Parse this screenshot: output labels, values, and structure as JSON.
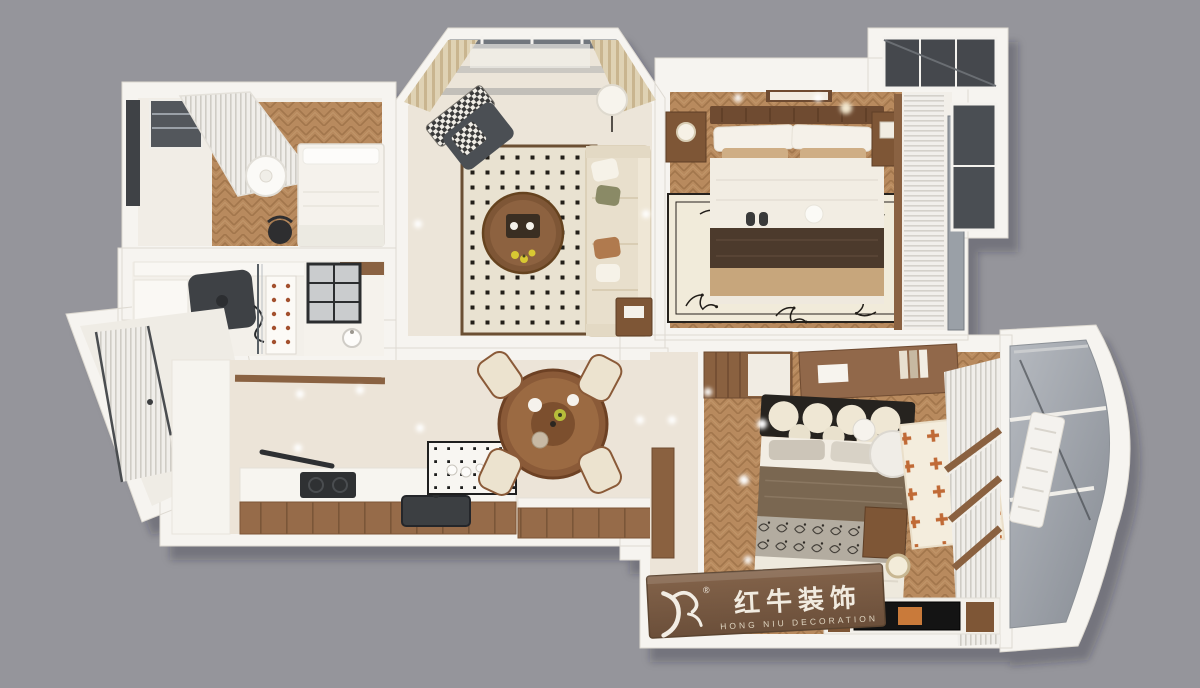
{
  "scene": {
    "type": "3D apartment floor-plan render, top-down view",
    "background_color": "#95959B"
  },
  "watermark": {
    "brand_cn": "红牛装饰",
    "brand_en": "HONG NIU DECORATION",
    "registered": "®",
    "plank_color": "#7D5F46",
    "text_color": "#F1EBE0"
  },
  "palette": {
    "wall_white": "#F6F4F0",
    "floor_wood": "#B88A5E",
    "floor_cream": "#ECE4D8",
    "rug_cream": "#E9E2D1",
    "rug_dot_black": "#211D18",
    "sofa_beige": "#E8DFCC",
    "blanket_dark_brown": "#4C3A2C",
    "bedding_tan": "#C7A67C",
    "accent_orange_cross": "#C06A36",
    "glass_gray": "#9AA0A7",
    "frame_dark": "#3C4045"
  },
  "rooms": [
    {
      "name": "small bedroom",
      "position": "top-left",
      "contents": [
        "white double bed",
        "flower pendant lamp",
        "black chair",
        "striped curtain",
        "dark window"
      ]
    },
    {
      "name": "living room",
      "position": "top-center",
      "contents": [
        "bay window with beige curtains",
        "dotted rug",
        "round wood coffee table",
        "beige corner sofa",
        "checkered armchair",
        "floor lamp",
        "side table"
      ]
    },
    {
      "name": "master bedroom",
      "position": "top-right",
      "contents": [
        "wood headboard bed",
        "dark brown runner blanket",
        "floral border rug",
        "two nightstands",
        "white blinds",
        "balcony glazing"
      ]
    },
    {
      "name": "study",
      "position": "middle-left",
      "contents": [
        "dark desk with monitor",
        "display cabinet with red dots",
        "glass partition"
      ]
    },
    {
      "name": "bathroom",
      "position": "middle-left",
      "contents": [
        "black grid window",
        "washbasin"
      ]
    },
    {
      "name": "laundry balcony",
      "position": "far-left",
      "contents": [
        "frosted sliding door",
        "white counter"
      ]
    },
    {
      "name": "kitchen",
      "position": "bottom-left",
      "contents": [
        "wood-front counter",
        "cooktop",
        "dark sink",
        "black-dot tile backsplash"
      ]
    },
    {
      "name": "dining room",
      "position": "center",
      "contents": [
        "round wood table with lazy susan",
        "four beige chairs",
        "wood-front sideboard"
      ]
    },
    {
      "name": "second bedroom",
      "position": "bottom-right",
      "contents": [
        "bed with circle-pattern headboard",
        "layered bedding",
        "orange cross rug",
        "desk with shelves",
        "TV cabinet",
        "round lounge chair",
        "white blinds"
      ]
    },
    {
      "name": "curved balcony",
      "position": "right",
      "contents": [
        "gray glazing panels",
        "white radiator"
      ]
    }
  ]
}
